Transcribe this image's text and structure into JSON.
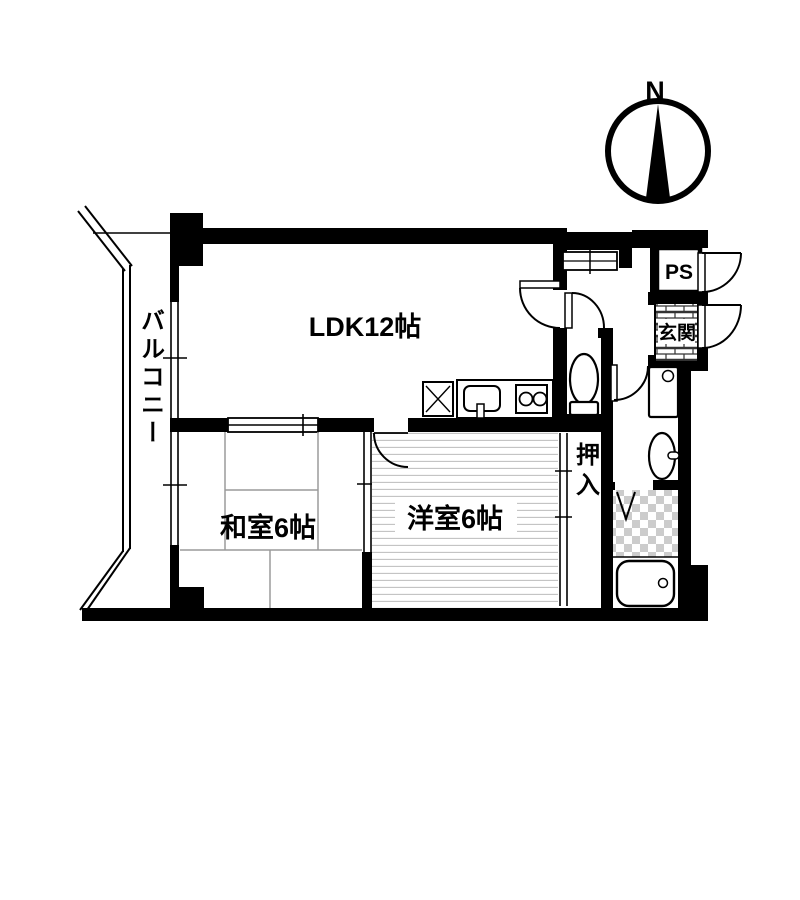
{
  "title": "apartment-floor-plan",
  "compass": {
    "label": "N"
  },
  "rooms": {
    "ldk": {
      "label": "LDK12帖"
    },
    "washitsu": {
      "label": "和室6帖"
    },
    "youshitsu": {
      "label": "洋室6帖"
    },
    "oshiire": {
      "label": "押入"
    },
    "balcony": {
      "label": "バルコニー"
    },
    "genkan": {
      "label": "玄関"
    },
    "ps": {
      "label": "PS"
    }
  },
  "icons": [
    "compass-needle-icon",
    "toilet-icon",
    "bathtub-icon",
    "kitchen-sink-icon",
    "stove-icon",
    "refrigerator-icon",
    "washing-machine-icon",
    "washbasin-icon",
    "door-swing-icon",
    "sliding-door-icon",
    "folding-door-icon",
    "window-icon",
    "brick-tile",
    "checker-tile"
  ],
  "colors": {
    "wall": "#000000",
    "background": "#ffffff",
    "tatami_line": "#9a9a9a",
    "floor_line": "#c4c4c4",
    "tile_check": "#cccccc",
    "brick_line": "#333333"
  }
}
